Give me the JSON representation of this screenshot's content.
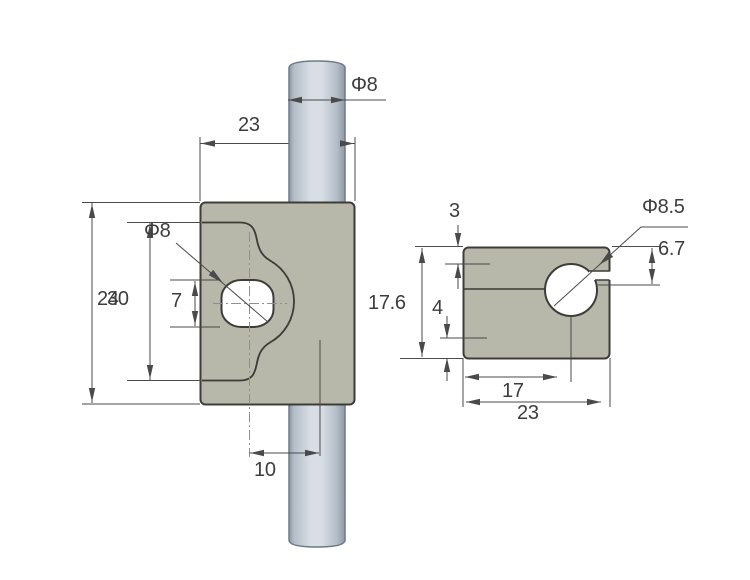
{
  "drawing": {
    "front_view": {
      "labels": {
        "rod_diameter": "Φ8",
        "block_width": "23",
        "outer_height": "30",
        "inner_height": "24",
        "hole_diameter": "Φ8",
        "hole_flat_height": "7",
        "hole_to_rod_offset": "10"
      }
    },
    "side_view": {
      "labels": {
        "slit_top_offset": "3",
        "block_height": "17.6",
        "bottom_step": "4",
        "hole_diameter": "Φ8.5",
        "hole_center_depth": "6.7",
        "hole_center_offset": "17",
        "block_width": "23"
      }
    }
  },
  "colors": {
    "bg": "#ffffff",
    "block_fill": "#b7b7aa",
    "block_stroke": "#3c3c38",
    "line": "#4a4a4a",
    "centerline": "#8f8f8f",
    "text": "#3d3d3d",
    "rod_edge": "#6f7a88",
    "rod_light": "#d8dee4",
    "rod_dark": "#8e99a7",
    "rod_mid": "#b4bec9"
  }
}
